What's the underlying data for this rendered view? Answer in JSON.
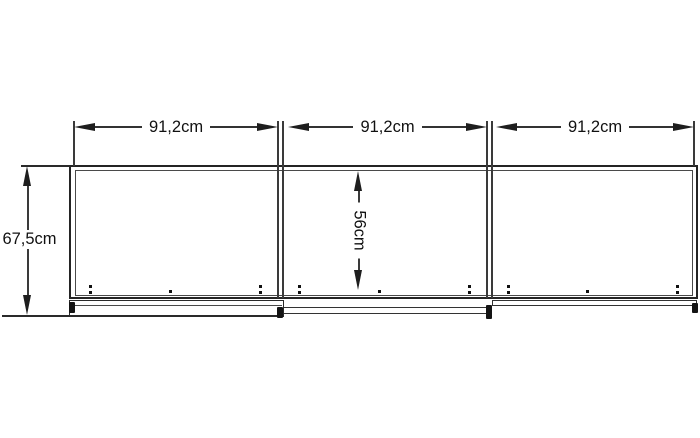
{
  "diagram": {
    "description": "Front elevation drawing of a three-section sliding-door cabinet with dimension lines",
    "colors": {
      "line": "#222222",
      "text": "#111111",
      "background": "#ffffff"
    },
    "labels": {
      "width_sections": [
        "91,2cm",
        "91,2cm",
        "91,2cm"
      ],
      "total_height": "67,5cm",
      "inner_height": "56cm"
    }
  }
}
